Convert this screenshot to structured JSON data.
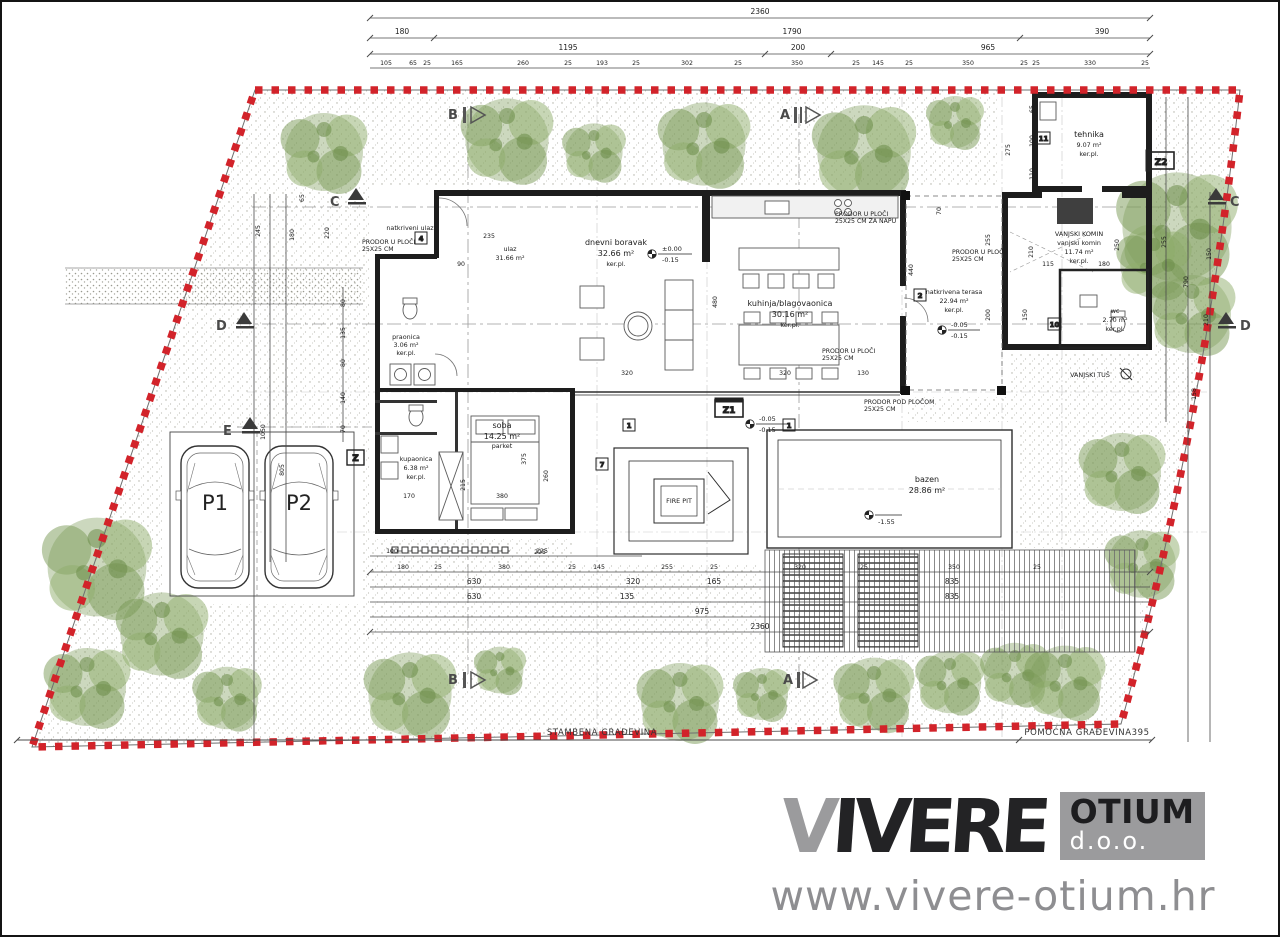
{
  "logo": {
    "brand_first": "V",
    "brand_rest": "IVERE",
    "box_line1": "OTIUM",
    "box_line2": "d.o.o.",
    "website": "www.vivere-otium.hr"
  },
  "site": {
    "bottom_left_label": "STAMBENA GRAĐEVINA",
    "bottom_right_label": "POMOĆNA GRAĐEVINA395"
  },
  "rooms": {
    "living": {
      "name": "dnevni boravak",
      "area": "32.66 m²",
      "floor": "ker.pl."
    },
    "kitchen": {
      "name": "kuhinja/blagovaonica",
      "area": "30.16 m²",
      "floor": "ker.pl."
    },
    "entry": {
      "name": "ulaz",
      "area": "31.66 m²",
      "floor": "ker.pl."
    },
    "porch": {
      "name": "natkriveni ulaz"
    },
    "laundry": {
      "name": "praonica",
      "area": "3.06 m²",
      "floor": "ker.pl."
    },
    "bathroom": {
      "name": "kupaonica",
      "area": "6.38 m²",
      "floor": "ker.pl."
    },
    "bedroom": {
      "name": "soba",
      "area": "14.25 m²",
      "floor": "parket"
    },
    "tech": {
      "name": "tehnika",
      "area": "9.07 m²",
      "floor": "ker.pl."
    },
    "chimney": {
      "caption": "VANJSKI KOMIN",
      "name": "vanjski komin",
      "area": "11.74 m²",
      "floor": "ker.pl."
    },
    "terrace": {
      "name": "natkrivena terasa",
      "area": "22.94 m²",
      "floor": "ker.pl."
    },
    "wc": {
      "name": "wc",
      "area": "2.70 m²",
      "floor": "ker.pl."
    },
    "pool": {
      "name": "bazen",
      "area": "28.86 m²"
    },
    "firepit": {
      "name": "FIRE PIT"
    },
    "shower": {
      "name": "VANJSKI TUŠ"
    },
    "parking1": "P1",
    "parking2": "P2"
  },
  "ann": {
    "p1a": "PRODOR U PLOČI",
    "p1b": "25X25 CM",
    "p2a": "PRODOR U PLOČI",
    "p2b": "25X25 CM ZA NAPU",
    "p3a": "PRODOR POD PLOČOM",
    "p3b": "25X25 CM"
  },
  "levels": {
    "zero": "±0.00",
    "m015": "-0.15",
    "m005": "-0.05",
    "m155": "-1.55"
  },
  "markers": {
    "a": "A",
    "b": "B",
    "c": "C",
    "d": "D",
    "e": "E",
    "z": "Z",
    "z1": "Z1",
    "z2": "Z2"
  },
  "boxes": {
    "n1": "1",
    "n2": "2",
    "n4": "4",
    "n7": "7",
    "n10": "10",
    "n11": "11"
  },
  "dims": {
    "t1": "2360",
    "t2": [
      "180",
      "1790",
      "390"
    ],
    "t3": [
      "1195",
      "200",
      "965"
    ],
    "t4": [
      "105",
      "65",
      "25",
      "165",
      "260",
      "25",
      "193",
      "25",
      "302",
      "25",
      "350",
      "25",
      "145",
      "25",
      "350",
      "25",
      "25",
      "330",
      "25"
    ],
    "b1": [
      "100",
      "225"
    ],
    "b2": [
      "180",
      "25",
      "380",
      "25",
      "145",
      "255",
      "25",
      "320",
      "25",
      "350",
      "25"
    ],
    "b3": [
      "630",
      "320",
      "165",
      "835"
    ],
    "b4": [
      "630",
      "135",
      "835"
    ],
    "b5": [
      "975",
      "2360"
    ],
    "l": [
      "65",
      "245",
      "180",
      "220",
      "1050",
      "805",
      "80",
      "135",
      "80",
      "140",
      "70"
    ],
    "r": [
      "275",
      "65",
      "100",
      "110",
      "255",
      "210",
      "790",
      "150",
      "158"
    ],
    "i": [
      "480",
      "320",
      "320",
      "130",
      "235",
      "90",
      "375",
      "380",
      "215",
      "225",
      "170",
      "115",
      "180",
      "250",
      "260",
      "255",
      "210",
      "200",
      "150",
      "440",
      "70"
    ]
  }
}
